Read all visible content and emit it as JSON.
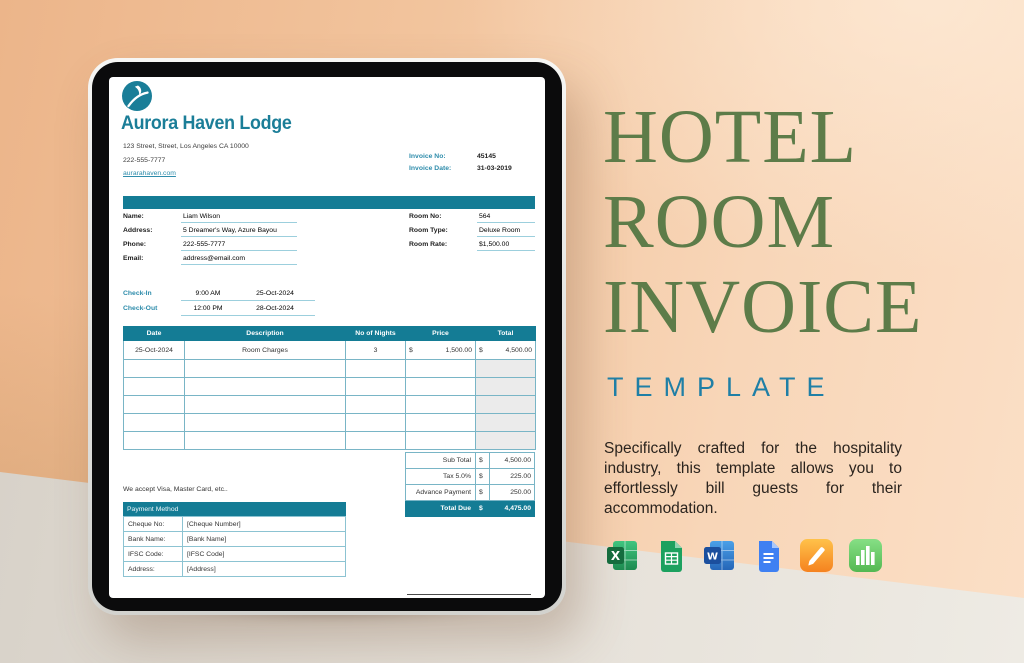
{
  "hero": {
    "title_lines": [
      "HOTEL",
      "ROOM",
      "INVOICE"
    ],
    "subtitle": "TEMPLATE",
    "description": "Specifically crafted for the hospitality industry, this template allows you to effortlessly bill guests for their accommodation.",
    "title_color": "#5d7c49",
    "subtitle_color": "#1f7fa6"
  },
  "apps": {
    "items": [
      "excel-icon",
      "google-sheets-icon",
      "word-icon",
      "google-docs-icon",
      "pages-icon",
      "numbers-icon"
    ],
    "empty_row_count_note": ""
  },
  "invoice": {
    "accent_color": "#147c95",
    "brand": {
      "name": "Aurora Haven Lodge",
      "address": "123 Street, Street, Los Angeles CA 10000",
      "phone": "222-555-7777",
      "website": "aurarahaven.com",
      "logo": "bird-swoosh-circle-icon"
    },
    "meta": {
      "invoice_no_label": "Invoice No:",
      "invoice_no": "45145",
      "invoice_date_label": "Invoice Date:",
      "invoice_date": "31-03-2019"
    },
    "guest": {
      "name_label": "Name:",
      "name": "Liam Wilson",
      "address_label": "Address:",
      "address": "5 Dreamer's Way, Azure Bayou",
      "phone_label": "Phone:",
      "phone": "222-555-7777",
      "email_label": "Email:",
      "email": "address@email.com",
      "room_no_label": "Room No:",
      "room_no": "564",
      "room_type_label": "Room Type:",
      "room_type": "Deluxe Room",
      "room_rate_label": "Room Rate:",
      "room_rate": "$1,500.00"
    },
    "stay": {
      "check_in_label": "Check-In",
      "check_in_time": "9:00 AM",
      "check_in_date": "25-Oct-2024",
      "check_out_label": "Check-Out",
      "check_out_time": "12:00 PM",
      "check_out_date": "28-Oct-2024"
    },
    "charges": {
      "headers": [
        "Date",
        "Description",
        "No of Nights",
        "Price",
        "Total"
      ],
      "row": {
        "date": "25-Oct-2024",
        "description": "Room Charges",
        "nights": "3",
        "price_currency": "$",
        "price": "1,500.00",
        "total_currency": "$",
        "total": "4,500.00"
      },
      "empty_row_count": 5
    },
    "totals": {
      "currency": "$",
      "sub_total_label": "Sub Total",
      "sub_total": "4,500.00",
      "tax_label": "Tax  5.0%",
      "tax": "225.00",
      "advance_label": "Advance Payment",
      "advance": "250.00",
      "total_due_label": "Total Due",
      "total_due": "4,475.00"
    },
    "payment": {
      "accept_note": "We accept Visa, Master Card, etc..",
      "header": "Payment Method",
      "cheque_label": "Cheque No:",
      "cheque": "[Cheque Number]",
      "bank_label": "Bank Name:",
      "bank": "[Bank Name]",
      "ifsc_label": "IFSC Code:",
      "ifsc": "[IFSC Code]",
      "address_label": "Address:",
      "address": "[Address]"
    }
  }
}
